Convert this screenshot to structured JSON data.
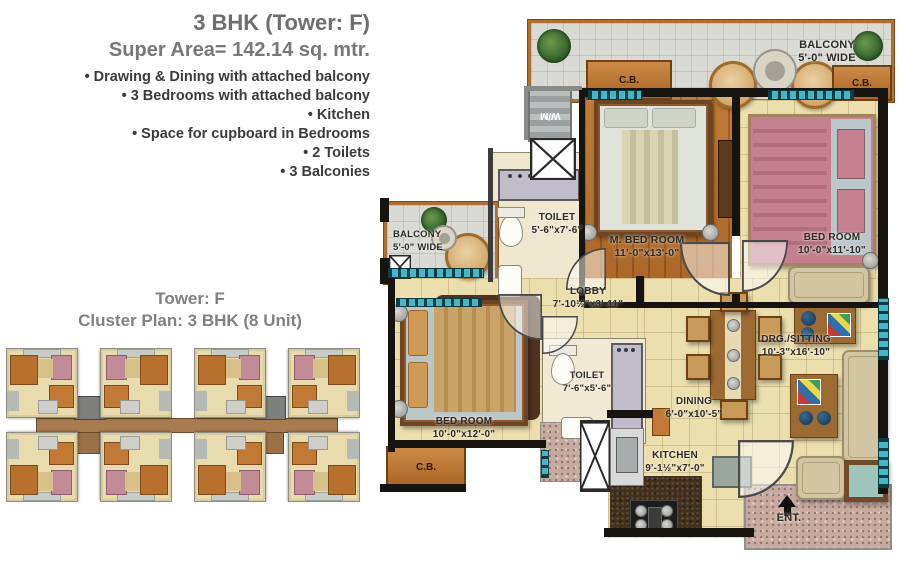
{
  "info_panel": {
    "title": "3 BHK (Tower: F)",
    "subtitle": "Super Area= 142.14 sq. mtr.",
    "features": [
      "• Drawing & Dining with attached balcony",
      "• 3 Bedrooms with attached balcony",
      "• Kitchen",
      "• Space for cupboard in Bedrooms",
      "• 2 Toilets",
      "• 3 Balconies"
    ]
  },
  "cluster_panel": {
    "title": "Tower: F",
    "subtitle": "Cluster Plan: 3 BHK (8 Unit)",
    "unit_count": 8
  },
  "floor_plan": {
    "balcony_top": {
      "name": "BALCONY",
      "size": "5'-0\" WIDE"
    },
    "balcony_left": {
      "name": "BALCONY",
      "size": "5'-0\" WIDE"
    },
    "toilet_top": {
      "name": "TOILET",
      "size": "5'-6\"x7'-6\""
    },
    "m_bedroom": {
      "name": "M. BED ROOM",
      "size": "11'-0\"x13'-0\""
    },
    "bedroom_right": {
      "name": "BED ROOM",
      "size": "10'-0\"x11'-10\""
    },
    "bedroom_bottom": {
      "name": "BED ROOM",
      "size": "10'-0\"x12'-0\""
    },
    "lobby": {
      "name": "LOBBY",
      "size": "7'-10½\"x3'-11\""
    },
    "drg_sitting": {
      "name": "DRG./SITTING",
      "size": "10'-3\"x16'-10\""
    },
    "dining": {
      "name": "DINING",
      "size": "6'-0\"x10'-5\""
    },
    "toilet_bottom": {
      "name": "TOILET",
      "size": "7'-6\"x5'-6\""
    },
    "kitchen": {
      "name": "KITCHEN",
      "size": "9'-1½\"x7'-0\""
    },
    "entrance": {
      "label": "ENT."
    },
    "washing_machine": {
      "label": "W/M"
    },
    "cupboard": {
      "label": "C.B."
    }
  },
  "colors": {
    "title_gray": "#6d6e71",
    "text_dark": "#3b3b3d",
    "wood_floor": "#b8722f",
    "beige_tile": "#ecdfae",
    "balcony_tile": "#d9dad4",
    "wall_black": "#17140f",
    "window_teal": "#45b6c6",
    "cupboard_orange": "#c08040",
    "bed_pink": "#c5808f",
    "sofa_beige": "#d2c6a2",
    "corridor_brown": "#a87c50"
  }
}
